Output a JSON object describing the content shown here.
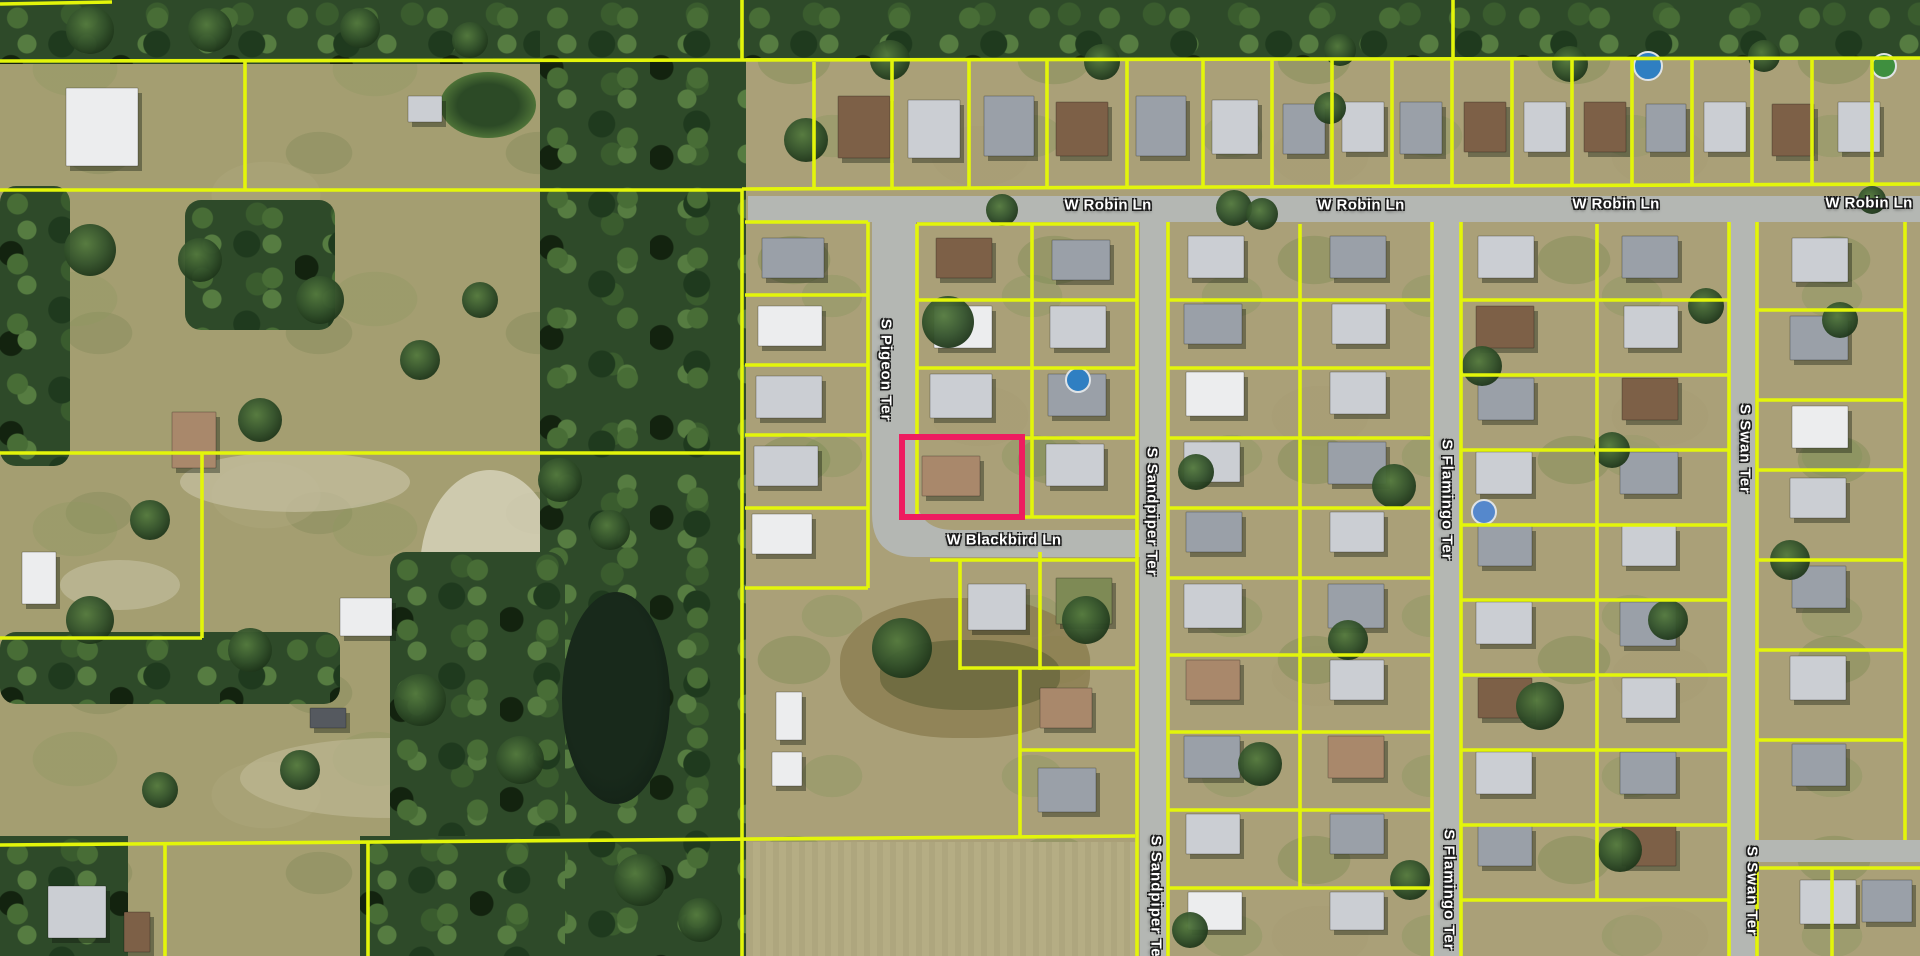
{
  "map": {
    "type": "aerial-parcel-map",
    "colors": {
      "parcel_line": "#e3f50a",
      "highlight": "#ee1c60",
      "road": "#b4b7b3",
      "label_text": "#ffffff",
      "label_outline": "#1c1c1c",
      "house_palette": [
        "#9aa0a8",
        "#cbced3",
        "#ecedee",
        "#7d6047",
        "#a9886b",
        "#55595f",
        "#7e8a55"
      ]
    },
    "streets": {
      "robin": "W Robin Ln",
      "pigeon": "S Pigeon Ter",
      "blackbird": "W Blackbird Ln",
      "sandpiper": "S Sandpiper Ter",
      "flamingo": "S Flamingo Ter",
      "swan": "S Swan Ter"
    },
    "labels": [
      {
        "text": "W Robin Ln",
        "x": 1108,
        "y": 205,
        "orientation": "horizontal"
      },
      {
        "text": "W Robin Ln",
        "x": 1361,
        "y": 205,
        "orientation": "horizontal"
      },
      {
        "text": "W Robin Ln",
        "x": 1616,
        "y": 204,
        "orientation": "horizontal"
      },
      {
        "text": "W Robin Ln",
        "x": 1869,
        "y": 203,
        "orientation": "horizontal"
      },
      {
        "text": "S Pigeon Ter",
        "x": 886,
        "y": 370,
        "orientation": "vertical"
      },
      {
        "text": "W Blackbird Ln",
        "x": 1004,
        "y": 540,
        "orientation": "horizontal"
      },
      {
        "text": "S Sandpiper Ter",
        "x": 1152,
        "y": 512,
        "orientation": "vertical"
      },
      {
        "text": "S Sandpiper Ter",
        "x": 1156,
        "y": 900,
        "orientation": "vertical"
      },
      {
        "text": "S Flamingo Ter",
        "x": 1447,
        "y": 500,
        "orientation": "vertical"
      },
      {
        "text": "S Flamingo Ter",
        "x": 1449,
        "y": 890,
        "orientation": "vertical"
      },
      {
        "text": "S Swan Ter",
        "x": 1745,
        "y": 449,
        "orientation": "vertical"
      },
      {
        "text": "S Swan Ter",
        "x": 1752,
        "y": 891,
        "orientation": "vertical"
      }
    ],
    "roads": [
      {
        "name": "W Robin Ln",
        "d": "M748,196 H1920 V222 H748 Z"
      },
      {
        "name": "S Pigeon Ter / W Blackbird Ln",
        "d": "M872,196 L916,196 L916,492 Q916,530 954,530 L1168,530 L1168,557 L914,557 Q872,557 872,514 L872,196 Z"
      },
      {
        "name": "S Sandpiper Ter",
        "d": "M1140,222 H1166 V956 H1140 Z"
      },
      {
        "name": "S Flamingo Ter",
        "d": "M1434,222 H1460 V956 H1434 Z"
      },
      {
        "name": "S Swan Ter",
        "d": "M1729,222 H1755 V956 H1729 Z"
      },
      {
        "name": "cross-street-east",
        "d": "M1755,840 H1920 V862 H1755 Z"
      }
    ],
    "highlight_parcel": {
      "x": 902,
      "y": 437,
      "width": 120,
      "height": 80
    },
    "parcel_lines": [
      [
        0,
        4,
        112,
        2
      ],
      [
        0,
        61,
        742,
        60
      ],
      [
        742,
        60,
        1920,
        58
      ],
      [
        245,
        62,
        245,
        190
      ],
      [
        0,
        190,
        742,
        190
      ],
      [
        742,
        0,
        742,
        61
      ],
      [
        742,
        190,
        742,
        956
      ],
      [
        0,
        453,
        742,
        453
      ],
      [
        202,
        453,
        202,
        638
      ],
      [
        0,
        638,
        202,
        638
      ],
      [
        0,
        845,
        1135,
        836
      ],
      [
        165,
        845,
        165,
        956
      ],
      [
        368,
        843,
        368,
        956
      ],
      [
        742,
        189,
        1920,
        184
      ],
      [
        814,
        62,
        814,
        188
      ],
      [
        892,
        61,
        892,
        187
      ],
      [
        969,
        61,
        969,
        187
      ],
      [
        1047,
        61,
        1047,
        186
      ],
      [
        1127,
        60,
        1127,
        186
      ],
      [
        1203,
        60,
        1203,
        186
      ],
      [
        1272,
        60,
        1272,
        186
      ],
      [
        1332,
        60,
        1332,
        185
      ],
      [
        1392,
        60,
        1392,
        185
      ],
      [
        1452,
        59,
        1452,
        185
      ],
      [
        1512,
        59,
        1512,
        185
      ],
      [
        1572,
        59,
        1572,
        185
      ],
      [
        1632,
        59,
        1632,
        185
      ],
      [
        1692,
        59,
        1692,
        185
      ],
      [
        1752,
        58,
        1752,
        184
      ],
      [
        1812,
        58,
        1812,
        184
      ],
      [
        1872,
        58,
        1872,
        184
      ],
      [
        1453,
        0,
        1453,
        59
      ],
      [
        868,
        222,
        868,
        588
      ],
      [
        745,
        222,
        868,
        222
      ],
      [
        745,
        295,
        868,
        295
      ],
      [
        745,
        365,
        868,
        365
      ],
      [
        745,
        435,
        868,
        435
      ],
      [
        745,
        508,
        868,
        508
      ],
      [
        745,
        588,
        868,
        588
      ],
      [
        917,
        224,
        917,
        518
      ],
      [
        1032,
        224,
        1032,
        518
      ],
      [
        1137,
        222,
        1137,
        956
      ],
      [
        917,
        224,
        1137,
        224
      ],
      [
        917,
        300,
        1137,
        300
      ],
      [
        917,
        368,
        1137,
        368
      ],
      [
        1022,
        438,
        1137,
        438
      ],
      [
        1020,
        517,
        1137,
        517
      ],
      [
        930,
        560,
        1137,
        560
      ],
      [
        960,
        560,
        960,
        670
      ],
      [
        1040,
        552,
        1040,
        670
      ],
      [
        960,
        668,
        1137,
        668
      ],
      [
        1020,
        668,
        1020,
        838
      ],
      [
        1020,
        750,
        1137,
        750
      ],
      [
        1168,
        222,
        1168,
        956
      ],
      [
        1432,
        222,
        1432,
        956
      ],
      [
        1300,
        224,
        1300,
        888
      ],
      [
        1168,
        300,
        1432,
        300
      ],
      [
        1168,
        368,
        1432,
        368
      ],
      [
        1168,
        438,
        1432,
        438
      ],
      [
        1168,
        508,
        1432,
        508
      ],
      [
        1168,
        578,
        1432,
        578
      ],
      [
        1168,
        655,
        1432,
        655
      ],
      [
        1168,
        732,
        1432,
        732
      ],
      [
        1168,
        810,
        1432,
        810
      ],
      [
        1168,
        888,
        1432,
        888
      ],
      [
        1461,
        222,
        1461,
        956
      ],
      [
        1729,
        222,
        1729,
        956
      ],
      [
        1597,
        224,
        1597,
        900
      ],
      [
        1461,
        300,
        1729,
        300
      ],
      [
        1461,
        375,
        1729,
        375
      ],
      [
        1461,
        450,
        1729,
        450
      ],
      [
        1461,
        525,
        1729,
        525
      ],
      [
        1461,
        600,
        1729,
        600
      ],
      [
        1461,
        675,
        1729,
        675
      ],
      [
        1461,
        750,
        1729,
        750
      ],
      [
        1461,
        825,
        1729,
        825
      ],
      [
        1461,
        900,
        1729,
        900
      ],
      [
        1757,
        222,
        1757,
        840
      ],
      [
        1757,
        862,
        1757,
        956
      ],
      [
        1905,
        222,
        1905,
        840
      ],
      [
        1757,
        310,
        1905,
        310
      ],
      [
        1757,
        400,
        1905,
        400
      ],
      [
        1757,
        470,
        1905,
        470
      ],
      [
        1757,
        560,
        1905,
        560
      ],
      [
        1757,
        650,
        1905,
        650
      ],
      [
        1757,
        740,
        1905,
        740
      ],
      [
        1757,
        868,
        1920,
        868
      ],
      [
        1832,
        868,
        1832,
        956
      ]
    ],
    "houses": [
      [
        838,
        96,
        52,
        62,
        3
      ],
      [
        908,
        100,
        52,
        58,
        1
      ],
      [
        984,
        96,
        50,
        60,
        0
      ],
      [
        1056,
        102,
        52,
        54,
        3
      ],
      [
        1136,
        96,
        50,
        60,
        0
      ],
      [
        1212,
        100,
        46,
        54,
        1
      ],
      [
        1283,
        104,
        42,
        50,
        0
      ],
      [
        1342,
        102,
        42,
        50,
        1
      ],
      [
        1400,
        102,
        42,
        52,
        0
      ],
      [
        1464,
        102,
        42,
        50,
        3
      ],
      [
        1524,
        102,
        42,
        50,
        1
      ],
      [
        1584,
        102,
        42,
        50,
        3
      ],
      [
        1646,
        104,
        40,
        48,
        0
      ],
      [
        1704,
        102,
        42,
        50,
        1
      ],
      [
        1772,
        104,
        42,
        52,
        3
      ],
      [
        1838,
        102,
        42,
        50,
        1
      ],
      [
        762,
        238,
        62,
        40,
        0
      ],
      [
        758,
        306,
        64,
        40,
        2
      ],
      [
        756,
        376,
        66,
        42,
        1
      ],
      [
        754,
        446,
        64,
        40,
        1
      ],
      [
        752,
        514,
        60,
        40,
        2
      ],
      [
        936,
        238,
        56,
        40,
        3
      ],
      [
        934,
        306,
        58,
        42,
        2
      ],
      [
        930,
        374,
        62,
        44,
        1
      ],
      [
        922,
        456,
        58,
        40,
        4
      ],
      [
        1052,
        240,
        58,
        40,
        0
      ],
      [
        1050,
        306,
        56,
        42,
        1
      ],
      [
        1048,
        374,
        58,
        42,
        0
      ],
      [
        1046,
        444,
        58,
        42,
        1
      ],
      [
        968,
        584,
        58,
        46,
        1
      ],
      [
        1056,
        578,
        56,
        46,
        6
      ],
      [
        1040,
        688,
        52,
        40,
        4
      ],
      [
        1038,
        768,
        58,
        44,
        0
      ],
      [
        1188,
        236,
        56,
        42,
        1
      ],
      [
        1184,
        304,
        58,
        40,
        0
      ],
      [
        1186,
        372,
        58,
        44,
        2
      ],
      [
        1184,
        442,
        56,
        40,
        1
      ],
      [
        1186,
        512,
        56,
        40,
        0
      ],
      [
        1184,
        584,
        58,
        44,
        1
      ],
      [
        1186,
        660,
        54,
        40,
        4
      ],
      [
        1184,
        736,
        56,
        42,
        0
      ],
      [
        1186,
        814,
        54,
        40,
        1
      ],
      [
        1188,
        892,
        54,
        38,
        2
      ],
      [
        1330,
        236,
        56,
        42,
        0
      ],
      [
        1332,
        304,
        54,
        40,
        1
      ],
      [
        1330,
        372,
        56,
        42,
        1
      ],
      [
        1328,
        442,
        58,
        42,
        0
      ],
      [
        1330,
        512,
        54,
        40,
        1
      ],
      [
        1328,
        584,
        56,
        44,
        0
      ],
      [
        1330,
        660,
        54,
        40,
        1
      ],
      [
        1328,
        736,
        56,
        42,
        4
      ],
      [
        1330,
        814,
        54,
        40,
        0
      ],
      [
        1330,
        892,
        54,
        38,
        1
      ],
      [
        1478,
        236,
        56,
        42,
        1
      ],
      [
        1476,
        306,
        58,
        42,
        3
      ],
      [
        1478,
        378,
        56,
        42,
        0
      ],
      [
        1476,
        452,
        56,
        42,
        1
      ],
      [
        1478,
        526,
        54,
        40,
        0
      ],
      [
        1476,
        602,
        56,
        42,
        1
      ],
      [
        1478,
        678,
        54,
        40,
        3
      ],
      [
        1476,
        752,
        56,
        42,
        1
      ],
      [
        1478,
        826,
        54,
        40,
        0
      ],
      [
        1622,
        236,
        56,
        42,
        0
      ],
      [
        1624,
        306,
        54,
        42,
        1
      ],
      [
        1622,
        378,
        56,
        42,
        3
      ],
      [
        1620,
        452,
        58,
        42,
        0
      ],
      [
        1622,
        526,
        54,
        40,
        1
      ],
      [
        1620,
        602,
        56,
        44,
        0
      ],
      [
        1622,
        678,
        54,
        40,
        1
      ],
      [
        1620,
        752,
        56,
        42,
        0
      ],
      [
        1622,
        826,
        54,
        40,
        3
      ],
      [
        1792,
        238,
        56,
        44,
        1
      ],
      [
        1790,
        316,
        58,
        44,
        0
      ],
      [
        1792,
        406,
        56,
        42,
        2
      ],
      [
        1790,
        478,
        56,
        40,
        1
      ],
      [
        1792,
        566,
        54,
        42,
        0
      ],
      [
        1790,
        656,
        56,
        44,
        1
      ],
      [
        1792,
        744,
        54,
        42,
        0
      ],
      [
        1800,
        880,
        56,
        44,
        1
      ],
      [
        1862,
        880,
        50,
        42,
        0
      ],
      [
        66,
        88,
        72,
        78,
        2
      ],
      [
        408,
        96,
        34,
        26,
        1
      ],
      [
        172,
        412,
        44,
        56,
        4
      ],
      [
        340,
        598,
        52,
        38,
        2
      ],
      [
        22,
        552,
        34,
        52,
        2
      ],
      [
        48,
        886,
        58,
        52,
        1
      ],
      [
        124,
        912,
        26,
        40,
        3
      ],
      [
        310,
        708,
        36,
        20,
        5
      ],
      [
        776,
        692,
        26,
        48,
        2
      ],
      [
        772,
        752,
        30,
        34,
        2
      ]
    ],
    "pools": [
      [
        1648,
        66,
        14,
        "#2f7fc2"
      ],
      [
        1884,
        66,
        12,
        "#3f8f3f"
      ],
      [
        1078,
        380,
        12,
        "#2f7fc2"
      ],
      [
        1484,
        512,
        12,
        "#5588cc"
      ]
    ],
    "trees": [
      [
        948,
        322,
        26
      ],
      [
        902,
        648,
        30
      ],
      [
        1086,
        620,
        24
      ],
      [
        1234,
        208,
        18
      ],
      [
        1262,
        214,
        16
      ],
      [
        1394,
        486,
        22
      ],
      [
        1540,
        706,
        24
      ],
      [
        1706,
        306,
        18
      ],
      [
        1260,
        764,
        22
      ],
      [
        1348,
        640,
        20
      ],
      [
        1196,
        472,
        18
      ],
      [
        1482,
        366,
        20
      ],
      [
        1612,
        450,
        18
      ],
      [
        1668,
        620,
        20
      ],
      [
        1840,
        320,
        18
      ],
      [
        1790,
        560,
        20
      ],
      [
        1620,
        850,
        22
      ],
      [
        1410,
        880,
        20
      ],
      [
        1190,
        930,
        18
      ],
      [
        1330,
        108,
        16
      ],
      [
        1570,
        64,
        18
      ],
      [
        1340,
        50,
        16
      ],
      [
        1102,
        62,
        18
      ],
      [
        890,
        60,
        20
      ],
      [
        806,
        140,
        22
      ],
      [
        1764,
        56,
        16
      ],
      [
        1872,
        200,
        14
      ],
      [
        1002,
        210,
        16
      ],
      [
        90,
        250,
        26
      ],
      [
        200,
        260,
        22
      ],
      [
        320,
        300,
        24
      ],
      [
        420,
        360,
        20
      ],
      [
        260,
        420,
        22
      ],
      [
        480,
        300,
        18
      ],
      [
        150,
        520,
        20
      ],
      [
        90,
        620,
        24
      ],
      [
        250,
        650,
        22
      ],
      [
        420,
        700,
        26
      ],
      [
        520,
        760,
        24
      ],
      [
        300,
        770,
        20
      ],
      [
        160,
        790,
        18
      ],
      [
        560,
        480,
        22
      ],
      [
        610,
        530,
        20
      ],
      [
        640,
        880,
        26
      ],
      [
        700,
        920,
        22
      ],
      [
        90,
        30,
        24
      ],
      [
        210,
        30,
        22
      ],
      [
        360,
        28,
        20
      ],
      [
        470,
        40,
        18
      ]
    ]
  }
}
